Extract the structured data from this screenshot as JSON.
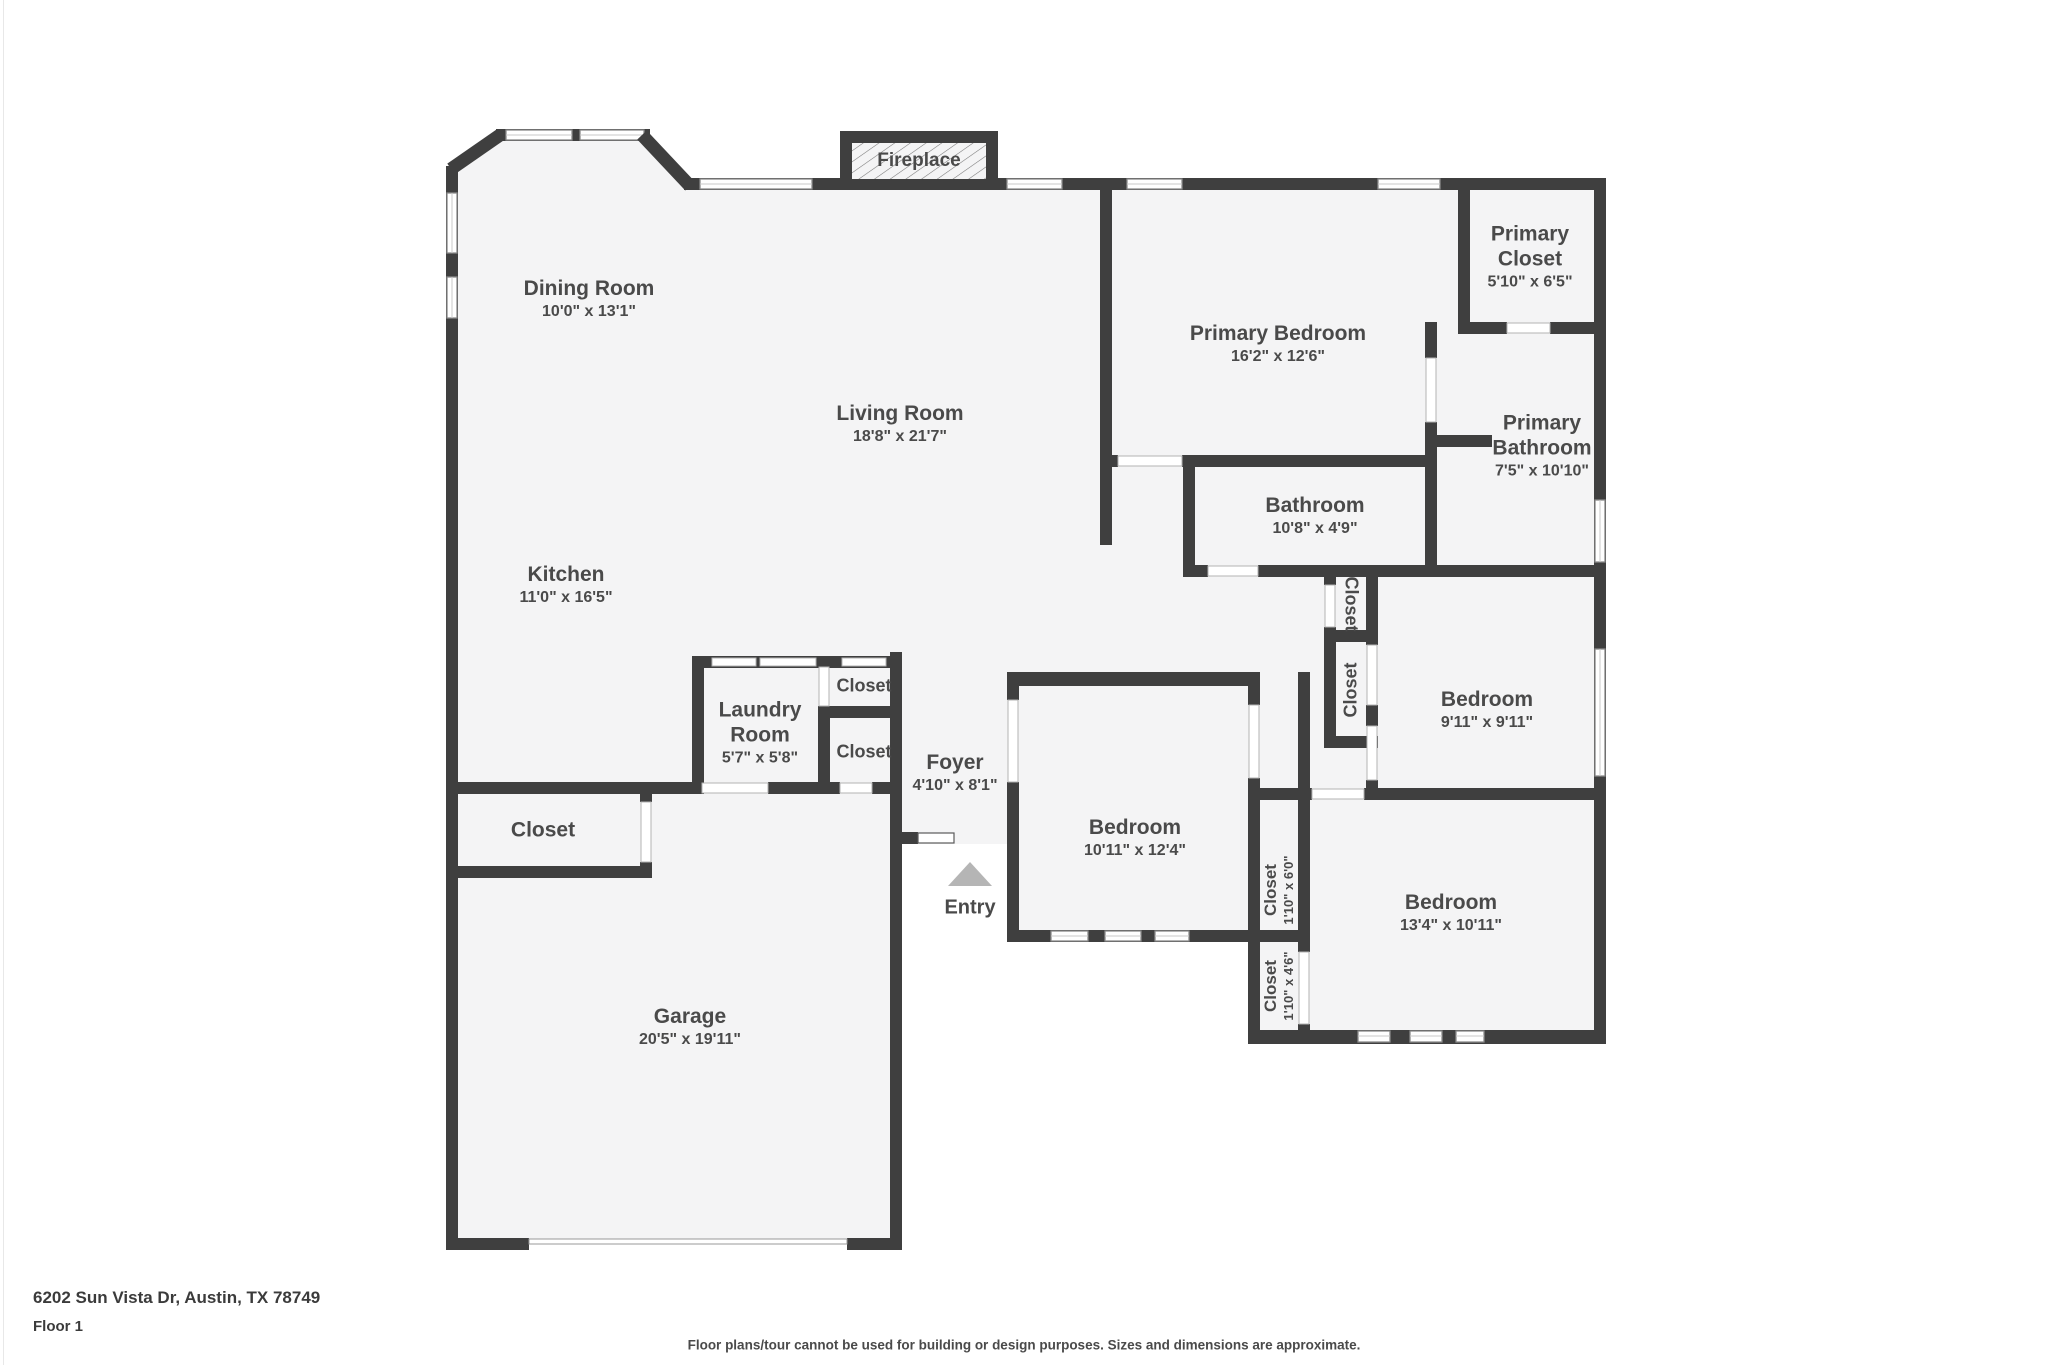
{
  "floorplan": {
    "fireplace_label": "Fireplace",
    "entry_label": "Entry",
    "rooms": [
      {
        "name": "Dining Room",
        "dims": "10'0\" x 13'1\""
      },
      {
        "name": "Living Room",
        "dims": "18'8\" x 21'7\""
      },
      {
        "name": "Primary Bedroom",
        "dims": "16'2\" x 12'6\""
      },
      {
        "name": "Primary Closet",
        "dims": "5'10\" x 6'5\""
      },
      {
        "name": "Primary Bathroom",
        "dims": "7'5\" x 10'10\""
      },
      {
        "name": "Bathroom",
        "dims": "10'8\" x 4'9\""
      },
      {
        "name": "Kitchen",
        "dims": "11'0\" x 16'5\""
      },
      {
        "name": "Laundry Room",
        "dims": "5'7\" x 5'8\""
      },
      {
        "name": "Closet",
        "dims": ""
      },
      {
        "name": "Closet",
        "dims": ""
      },
      {
        "name": "Foyer",
        "dims": "4'10\" x 8'1\""
      },
      {
        "name": "Closet",
        "dims": ""
      },
      {
        "name": "Bedroom",
        "dims": "10'11\" x 12'4\""
      },
      {
        "name": "Closet",
        "dims": "1'10\" x 6'0\""
      },
      {
        "name": "Closet",
        "dims": ""
      },
      {
        "name": "Closet",
        "dims": ""
      },
      {
        "name": "Bedroom",
        "dims": "9'11\" x 9'11\""
      },
      {
        "name": "Bedroom",
        "dims": "13'4\" x 10'11\""
      },
      {
        "name": "Closet",
        "dims": "1'10\" x 4'6\""
      },
      {
        "name": "Garage",
        "dims": "20'5\" x 19'11\""
      }
    ],
    "footer": {
      "address": "6202 Sun Vista Dr, Austin, TX 78749",
      "floor": "Floor 1",
      "disclaimer": "Floor plans/tour cannot be used for building or design purposes. Sizes and dimensions are approximate."
    },
    "colors": {
      "wall": "#3f3f3f",
      "room_fill": "#f4f4f5",
      "text": "#4a4a4a",
      "window_stroke": "#8a8a8a"
    }
  }
}
